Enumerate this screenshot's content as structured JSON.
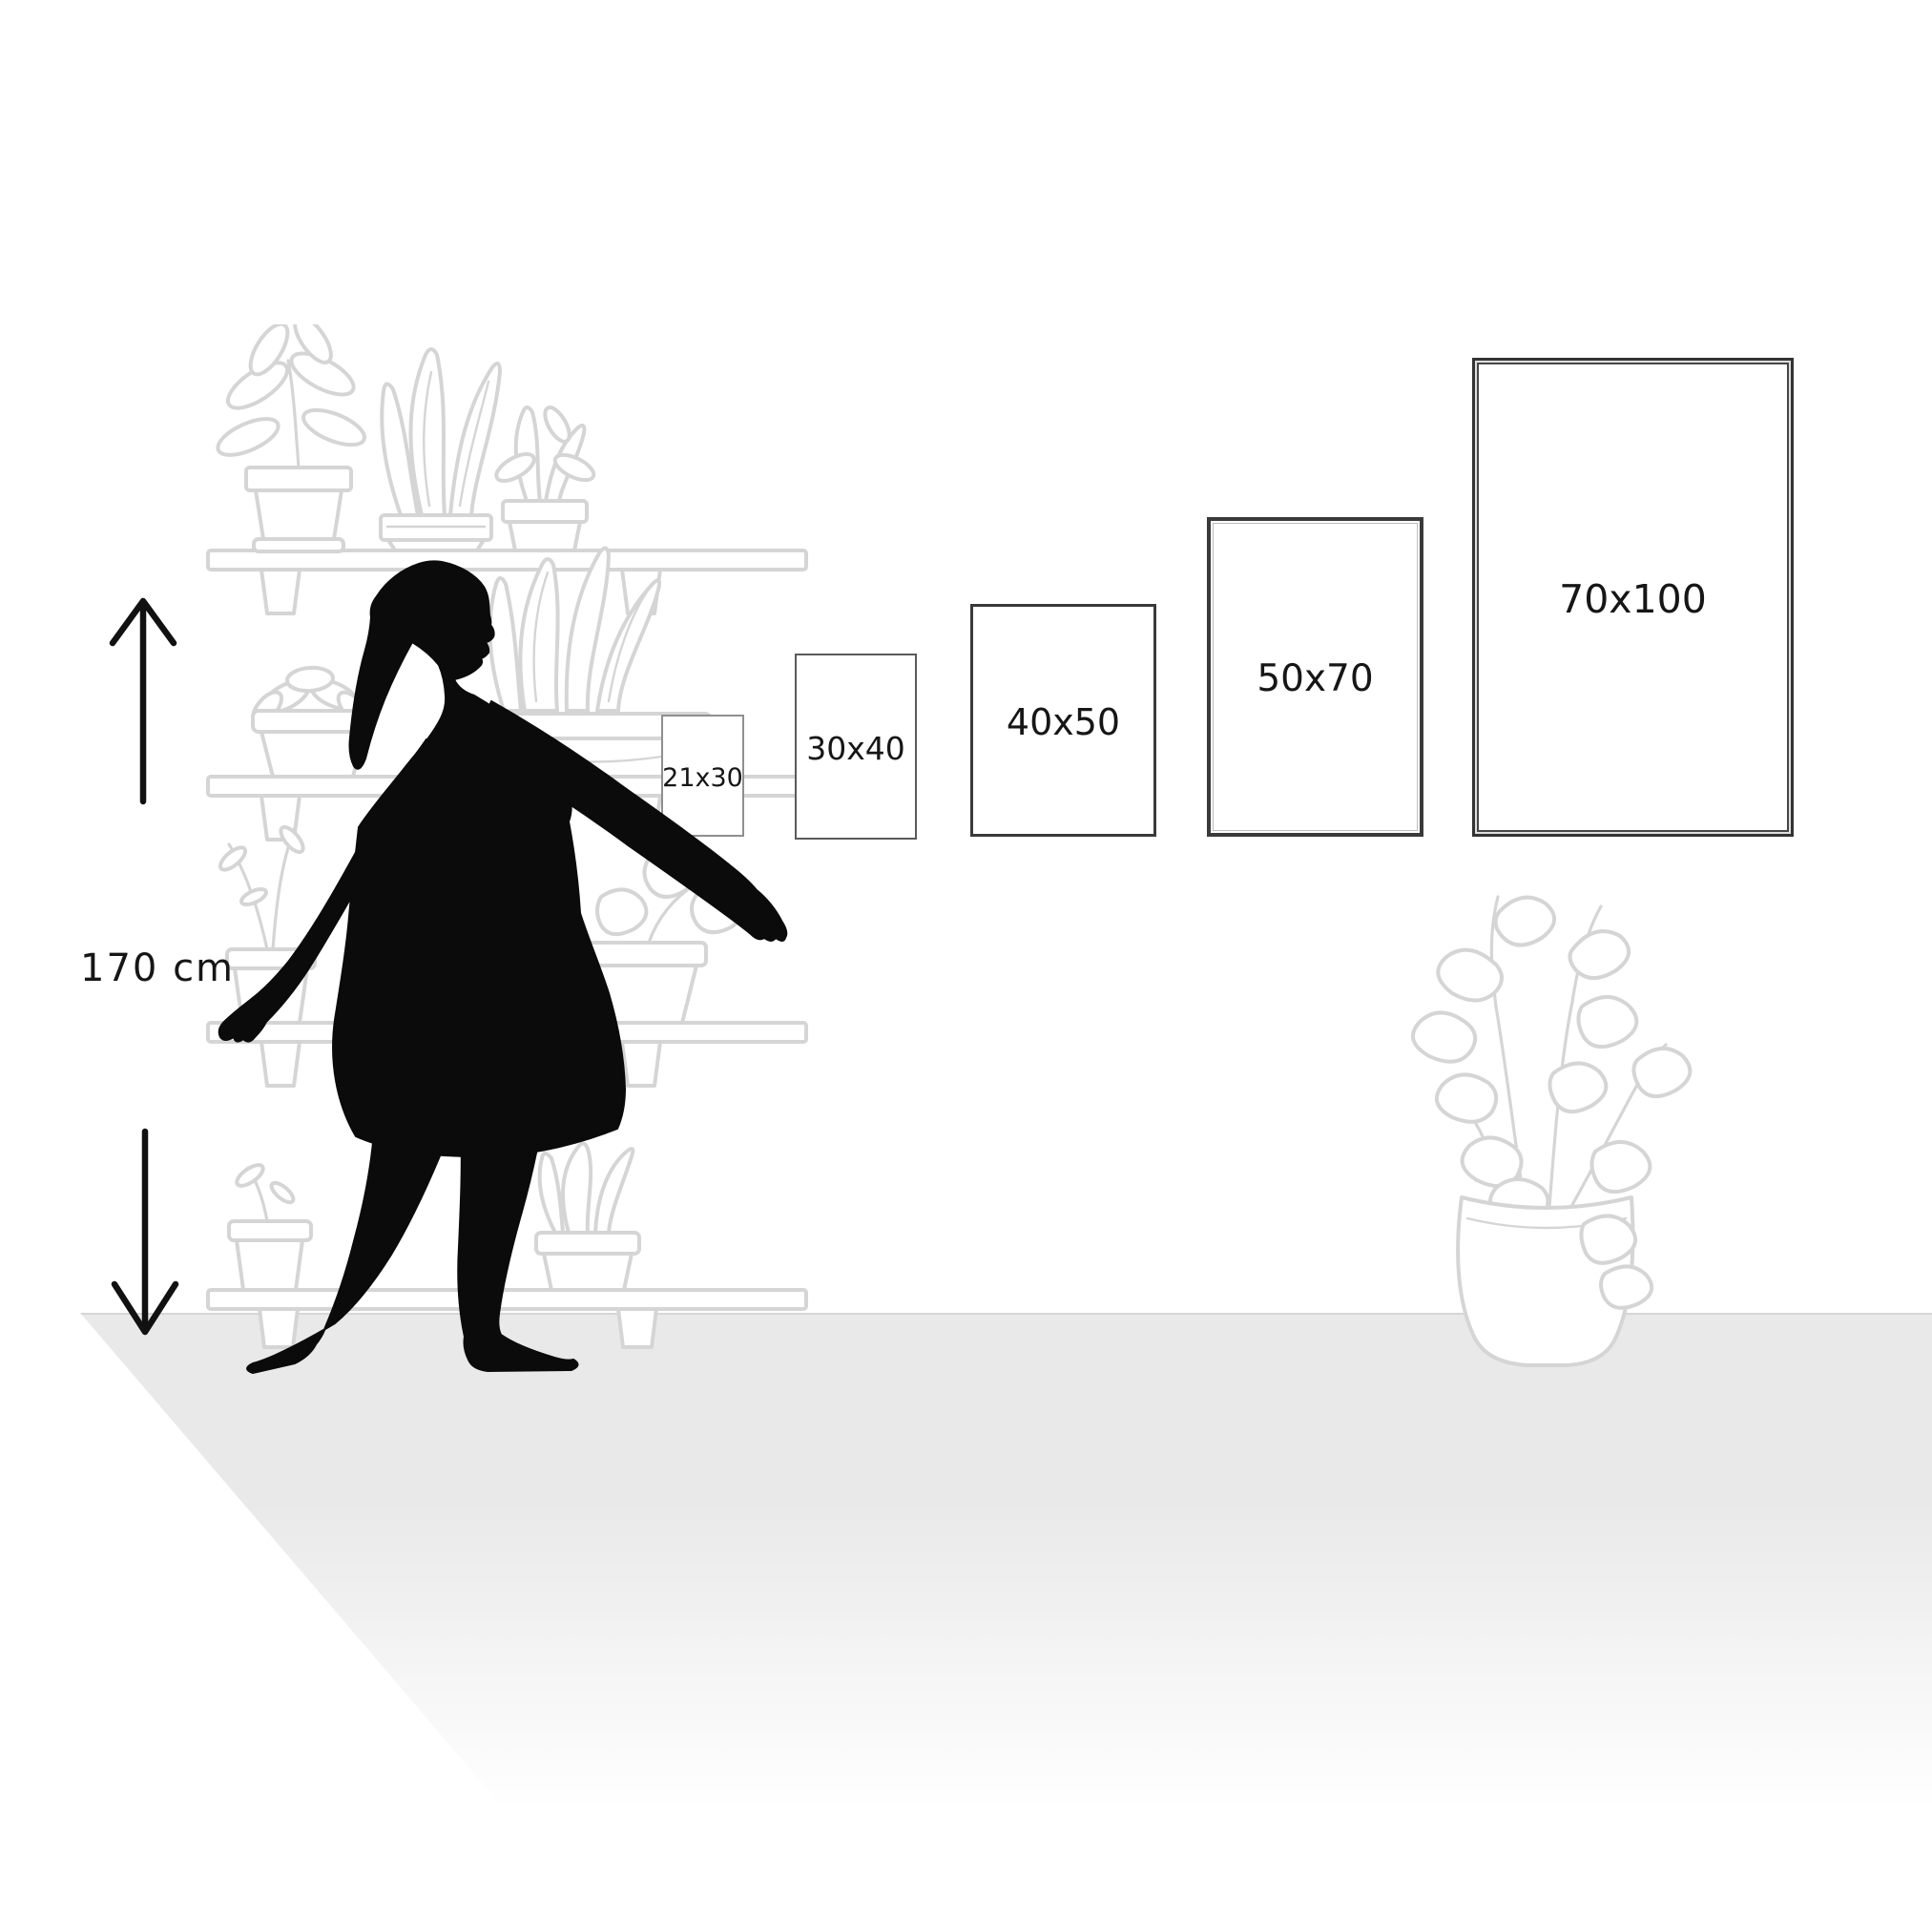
{
  "measurement": {
    "person_height_label": "170 cm"
  },
  "poster_sizes": [
    {
      "label": "21x30",
      "width_cm": 21,
      "height_cm": 30
    },
    {
      "label": "30x40",
      "width_cm": 30,
      "height_cm": 40
    },
    {
      "label": "40x50",
      "width_cm": 40,
      "height_cm": 50
    },
    {
      "label": "50x70",
      "width_cm": 50,
      "height_cm": 70
    },
    {
      "label": "70x100",
      "width_cm": 70,
      "height_cm": 100
    }
  ],
  "decor": {
    "person": "walking-woman-silhouette",
    "left_decor": "plant-shelf-line-art",
    "right_decor": "potted-plant-line-art",
    "measure_icons": [
      "arrow-up-icon",
      "arrow-down-icon"
    ]
  },
  "colors": {
    "silhouette": "#0b0b0b",
    "line_art": "#d5d5d5",
    "floor": "#e8e8e8",
    "floor_edge": "#d6d6d6",
    "text": "#161616",
    "frame_border_small": "#8f8f8f",
    "frame_border_medium": "#5a5a5a",
    "frame_border_dark": "#3a3a3a"
  }
}
